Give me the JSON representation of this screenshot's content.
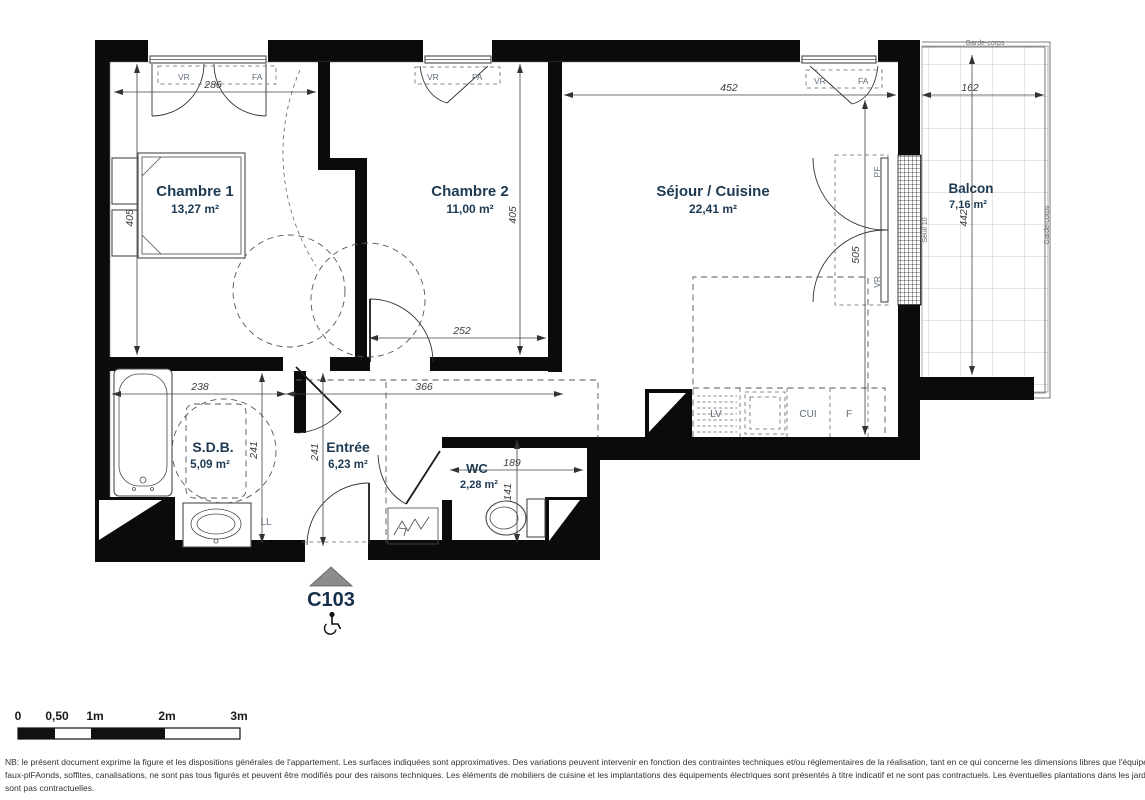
{
  "plan": {
    "unit": "C103",
    "rooms": {
      "chambre1": {
        "name": "Chambre 1",
        "area": "13,27 m²"
      },
      "chambre2": {
        "name": "Chambre 2",
        "area": "11,00 m²"
      },
      "sejour": {
        "name": "Séjour / Cuisine",
        "area": "22,41 m²"
      },
      "balcon": {
        "name": "Balcon",
        "area": "7,16 m²"
      },
      "sdb": {
        "name": "S.D.B.",
        "area": "5,09 m²"
      },
      "entree": {
        "name": "Entrée",
        "area": "6,23 m²"
      },
      "wc": {
        "name": "WC",
        "area": "2,28 m²"
      }
    },
    "dimensions": {
      "chambre1_width": "286",
      "chambre1_height": "405",
      "chambre2_width": "252",
      "chambre2_height": "405",
      "sejour_width": "452",
      "sejour_height": "505",
      "balcon_width": "162",
      "balcon_height": "442",
      "sdb_width": "238",
      "sdb_height": "241",
      "entree_height": "241",
      "couloir_width": "366",
      "wc_width": "189",
      "wc_height": "141"
    },
    "labels": {
      "vr": "VR",
      "fa": "FA",
      "pf": "PF",
      "lv": "LV",
      "cui": "CUI",
      "f": "F",
      "ll": "LL",
      "seuil": "Seuil 10",
      "garde_corps": "Garde-corps"
    }
  },
  "scale_bar": {
    "ticks": [
      "0",
      "0,50",
      "1m",
      "2m",
      "3m"
    ]
  },
  "disclaimer": {
    "line1": "NB: le présent document exprime la figure et les dispositions générales de l'appartement. Les surfaces indiquées sont approximatives. Des variations peuvent intervenir en fonction des contraintes techniques et/ou réglementaires de la réalisation, tant en ce qui concerne les dimensions libres que l'équipement. Les retombées de poutres,",
    "line2": "faux-plFAonds, soffites, canalisations, ne sont pas tous figurés et peuvent être modifiés pour des raisons techniques. Les éléments de mobiliers de cuisine et les implantations des équipements électriques sont présentés à titre indicatif et ne sont pas contractuels. Les éventuelles plantations dans les jardins privatifs ou espaces communs",
    "line3": "sont pas contractuelles."
  }
}
